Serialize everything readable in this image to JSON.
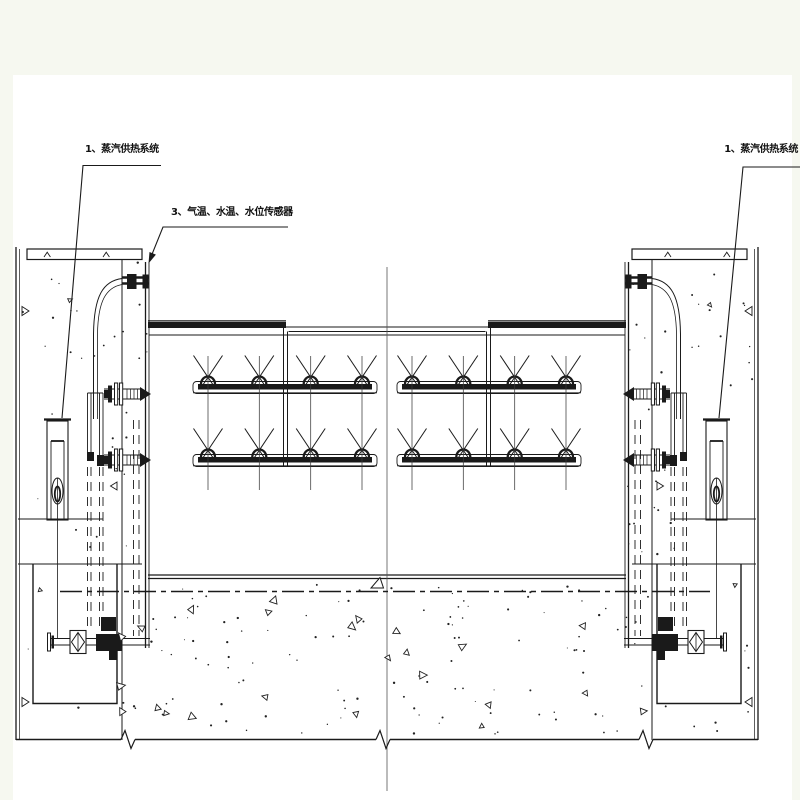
{
  "labels": {
    "steam_system_left": "1、蒸汽供热系统",
    "sensors": "3、气温、水温、水位传感器",
    "steam_system_right": "1、蒸汽供热系统"
  },
  "colors": {
    "ink": "#1a1a1a",
    "centerline": "#555555",
    "paper": "#ffffff",
    "mat": "#f6f8f0"
  }
}
